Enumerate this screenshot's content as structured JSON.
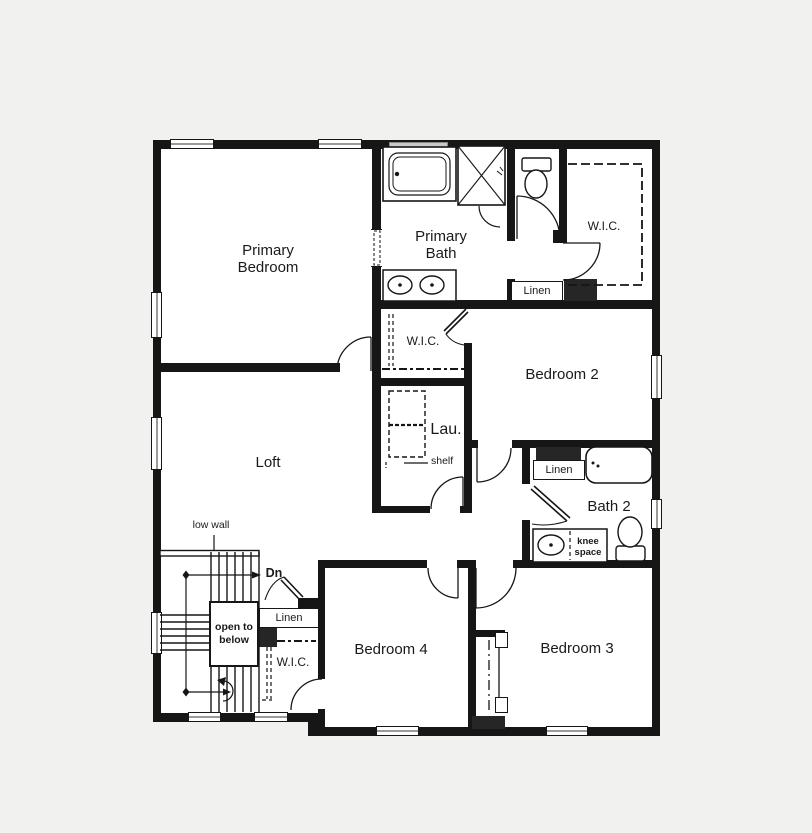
{
  "plan": {
    "colors": {
      "wall": "#161616",
      "background": "#f1f1ef",
      "floor": "#ffffff",
      "chase": "#262626"
    },
    "rooms": {
      "primary_bedroom": "Primary Bedroom",
      "primary_bath": "Primary Bath",
      "primary_wic": "W.I.C.",
      "upper_linen": "Linen",
      "bedroom_2": "Bedroom 2",
      "bedroom_2_wic": "W.I.C.",
      "laundry": "Lau.",
      "laundry_shelf": "shelf",
      "loft": "Loft",
      "bath_2": "Bath 2",
      "bath_2_linen": "Linen",
      "bath_2_knee_space": "knee space",
      "bedroom_3": "Bedroom 3",
      "bedroom_4": "Bedroom 4",
      "bedroom_4_wic": "W.I.C.",
      "hall_linen": "Linen",
      "stairs_dn": "Dn",
      "stairs_low_wall": "low wall",
      "stairs_open_to_below": "open to below"
    }
  }
}
